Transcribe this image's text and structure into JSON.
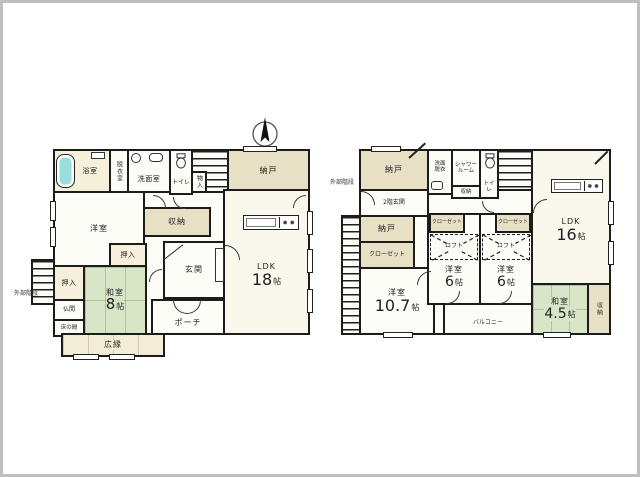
{
  "colors": {
    "wall": "#1c1c1c",
    "tatami_green": "#d8e6c6",
    "storage_tan": "#e8e0c4",
    "floor_cream": "#f5efdb",
    "ldk_cream": "#faf7ec",
    "room_white": "#fdfdf8",
    "bathtub_blue": "#98dedd",
    "frame_gray": "#bfbfbf"
  },
  "icons": {
    "compass": "north-compass",
    "bathtub": "bathtub",
    "toilet": "toilet-bowl",
    "washbasin": "washbasin",
    "washer": "washing-machine",
    "kitchen": "kitchen-counter",
    "stairs": "staircase",
    "shoe_cabinet": "shoe-cabinet",
    "loft_cross": "loft-dashed-cross"
  },
  "floor1": {
    "bath": "浴室",
    "dressing": "脱衣室",
    "washroom": "洗面室",
    "toilet": "トイレ",
    "monoire": "物入",
    "nando": "納戸",
    "youshitsu": "洋室",
    "shunou": "収納",
    "oshiire_top": "押入",
    "oshiire_left": "押入",
    "genkan": "玄関",
    "ldk": "LDK",
    "ldk_num": "18",
    "ldk_unit": "帖",
    "washitsu": "和室",
    "washitsu_num": "8",
    "washitsu_unit": "帖",
    "butsuma": "仏間",
    "tokonoma": "床の間",
    "hiroen": "広縁",
    "porch": "ポーチ",
    "ext_stairs": "外部階段"
  },
  "floor2": {
    "nando_top": "納戸",
    "ext_stairs": "外部階段",
    "genkan2": "2階玄関",
    "senmen": "洗面脱衣",
    "shower": "シャワールーム",
    "shunou_small": "収納",
    "toilet": "トイレ",
    "ldk": "LDK",
    "ldk_num": "16",
    "ldk_unit": "帖",
    "nando_mid": "納戸",
    "closet_left": "クローゼット",
    "closet_a": "クローゼット",
    "closet_b": "クローゼット",
    "loft_a": "ロフト",
    "loft_b": "ロフト",
    "youshitsu_107": "洋室",
    "youshitsu_107_num": "10.7",
    "youshitsu_107_unit": "帖",
    "youshitsu_a": "洋室",
    "youshitsu_a_num": "6",
    "youshitsu_a_unit": "帖",
    "youshitsu_b": "洋室",
    "youshitsu_b_num": "6",
    "youshitsu_b_unit": "帖",
    "washitsu_45": "和室",
    "washitsu_45_num": "4.5",
    "washitsu_45_unit": "帖",
    "shunou_right": "収納",
    "balcony": "バルコニー"
  }
}
